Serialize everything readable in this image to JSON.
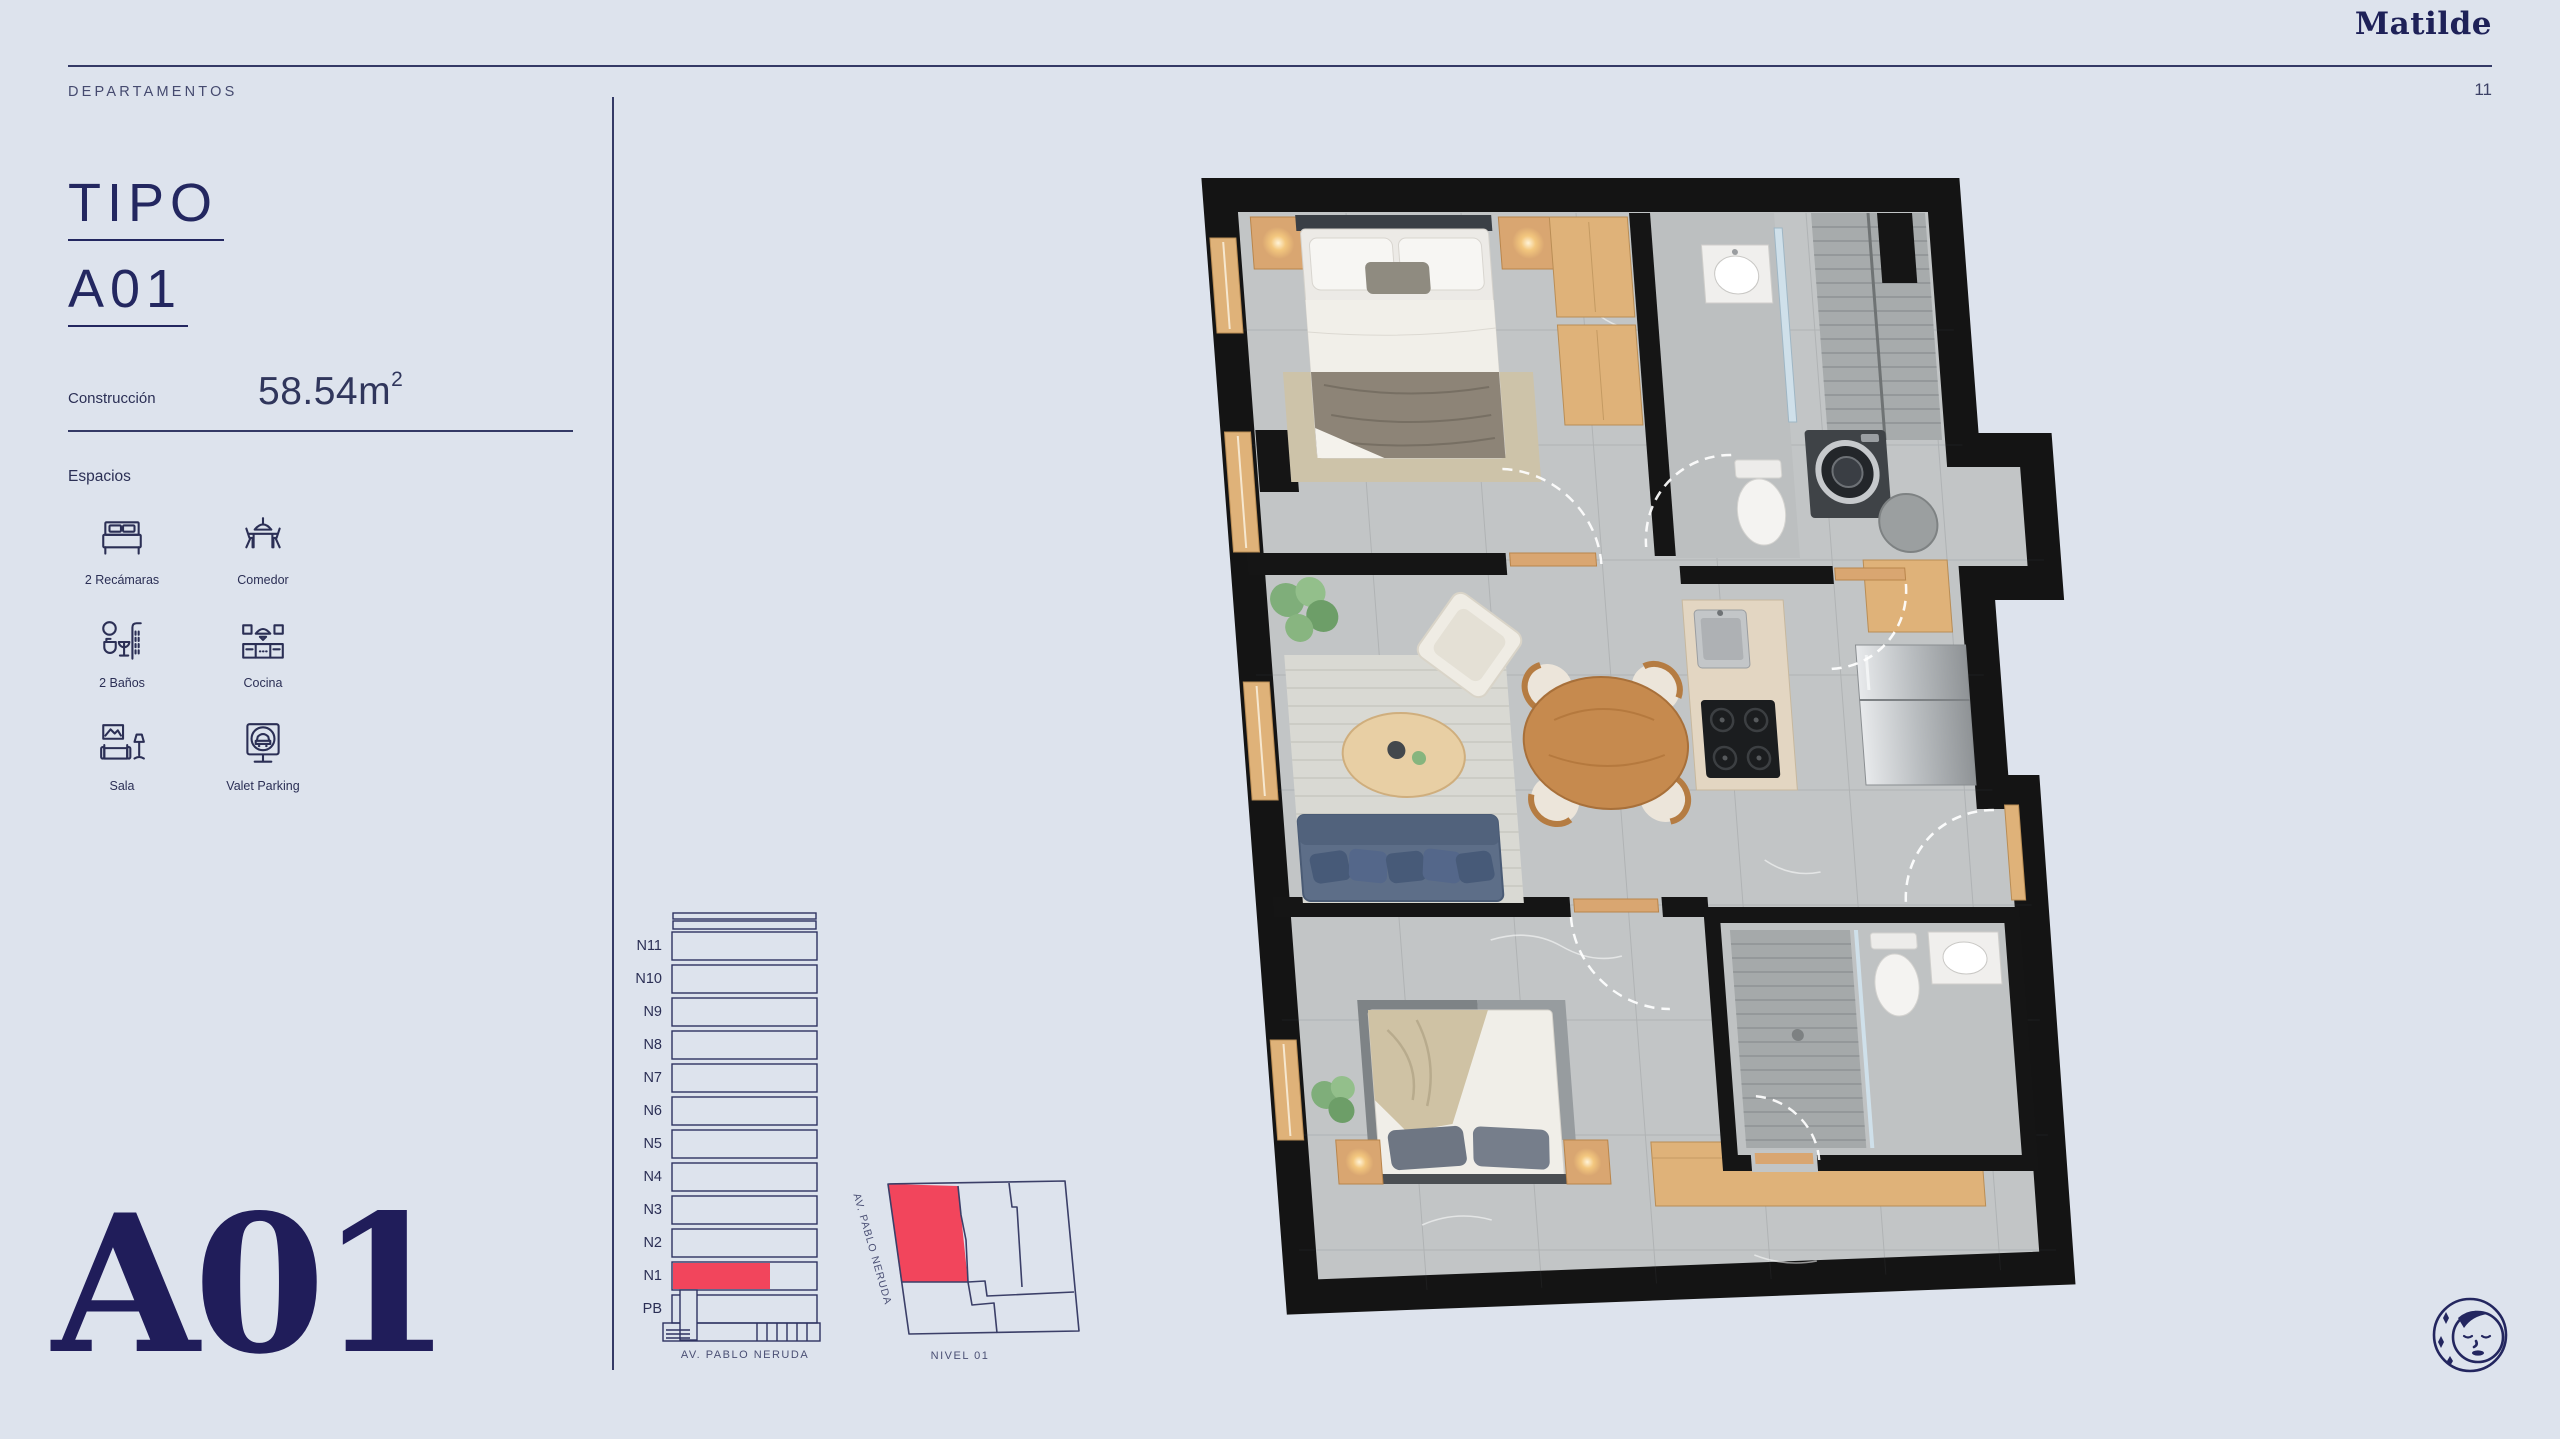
{
  "header": {
    "section": "DEPARTAMENTOS",
    "brand": "Matilde",
    "page_number": "11"
  },
  "unit": {
    "title_line1": "TIPO",
    "title_line2": "A01",
    "watermark": "A01"
  },
  "construction": {
    "label": "Construcción",
    "value": "58.54m",
    "superscript": "2"
  },
  "spaces": {
    "label": "Espacios",
    "items": [
      {
        "icon": "bed-icon",
        "label": "2 Recámaras"
      },
      {
        "icon": "dining-icon",
        "label": "Comedor"
      },
      {
        "icon": "bath-icon",
        "label": "2 Baños"
      },
      {
        "icon": "kitchen-icon",
        "label": "Cocina"
      },
      {
        "icon": "sofa-icon",
        "label": "Sala"
      },
      {
        "icon": "valet-parking-icon",
        "label": "Valet Parking"
      }
    ]
  },
  "elevation": {
    "floors": [
      {
        "label": "N11"
      },
      {
        "label": "N10"
      },
      {
        "label": "N9"
      },
      {
        "label": "N8"
      },
      {
        "label": "N7"
      },
      {
        "label": "N6"
      },
      {
        "label": "N5"
      },
      {
        "label": "N4"
      },
      {
        "label": "N3"
      },
      {
        "label": "N2"
      },
      {
        "label": "N1",
        "highlighted": true
      },
      {
        "label": "PB"
      }
    ],
    "highlighted_floor": "N1",
    "street_caption": "AV. PABLO NERUDA"
  },
  "site_plan": {
    "street_label": "AV. PABLO NERUDA",
    "caption": "NIVEL 01",
    "highlighted_unit": "A01"
  },
  "colors": {
    "background": "#dde3ed",
    "navy": "#232760",
    "accent_red": "#f2455c"
  }
}
